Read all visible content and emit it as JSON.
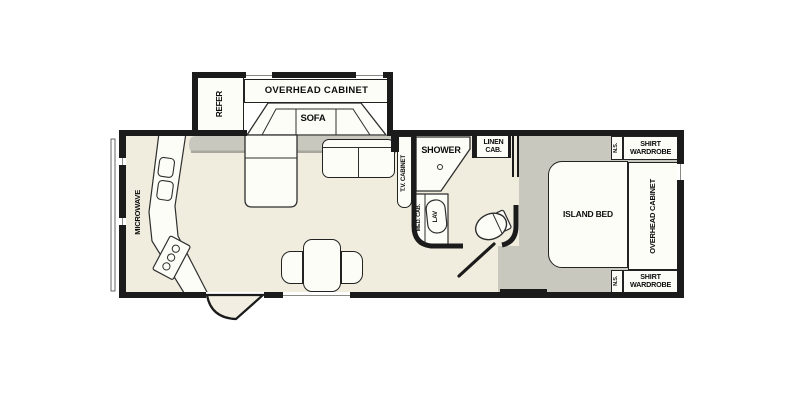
{
  "diagram_type": "rv-fifth-wheel-floorplan",
  "colors": {
    "background": "#ffffff",
    "wall": "#1b1b1b",
    "floor_main": "#f0edde",
    "floor_carpet": "#c9c8bf",
    "furniture": "#fdfdf8",
    "outline": "#2e2e2e"
  },
  "labels": {
    "refer": "REFER",
    "overhead_cabinet_front": "OVERHEAD CABINET",
    "sofa": "SOFA",
    "microwave": "MICROWAVE",
    "tv_cabinet": "T.V. CABINET",
    "shower": "SHOWER",
    "linen_cab": "LINEN CAB.",
    "med_cab": "MED. CAB.",
    "lav": "LAV",
    "island_bed": "ISLAND BED",
    "overhead_cabinet_bedroom": "OVERHEAD CABINET",
    "shirt_wardrobe_top": "SHIRT WARDROBE",
    "ns_top": "N.S.",
    "shirt_wardrobe_bottom": "SHIRT WARDROBE",
    "ns_bottom": "N.S."
  }
}
